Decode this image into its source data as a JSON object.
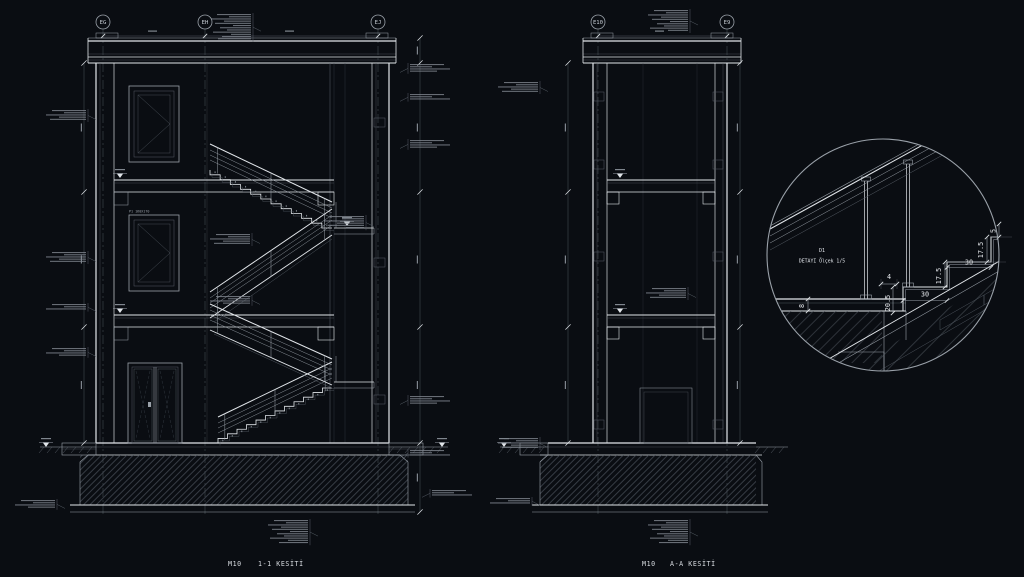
{
  "app": {
    "background": "#0a0d12",
    "line_bright": "#e2e6ea",
    "line_mid": "#9aa1a9",
    "line_dim": "#565d66"
  },
  "left_section": {
    "grid": [
      "EG",
      "EH",
      "EJ"
    ],
    "window_label": "P1 160X170",
    "caption": {
      "code": "M10",
      "title": "1-1 KESİTİ"
    }
  },
  "right_section": {
    "grid": [
      "E10",
      "E9"
    ],
    "caption": {
      "code": "M10",
      "title": "A-A KESİTİ"
    }
  },
  "detail": {
    "title_line1": "D1",
    "title_line2": "DETAYI Ölçek 1/5",
    "dims": {
      "nosing": "4",
      "tread_a": "30",
      "tread_b": "30",
      "riser_a": "17.5",
      "riser_b": "17.5",
      "slab_edge": "20.5",
      "top": "5",
      "slab_thickness": "8"
    }
  }
}
